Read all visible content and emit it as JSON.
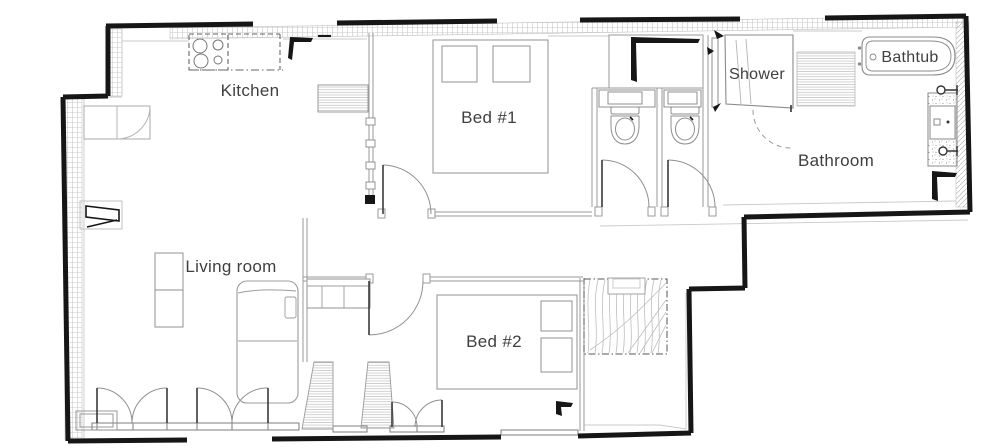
{
  "title": "Apartment floor plan",
  "colors": {
    "wall": "#161616",
    "line": "#8f8f8f",
    "light_line": "#c6c6c6",
    "hatch": "#bdbdbd",
    "text": "#3f3f3f",
    "background": "#ffffff"
  },
  "rooms": {
    "kitchen": {
      "label": "Kitchen"
    },
    "bed1": {
      "label": "Bed #1"
    },
    "shower": {
      "label": "Shower"
    },
    "bathtub": {
      "label": "Bathtub"
    },
    "bathroom": {
      "label": "Bathroom"
    },
    "living_room": {
      "label": "Living room"
    },
    "bed2": {
      "label": "Bed #2"
    }
  },
  "fixtures": [
    "stove",
    "kitchen-counter",
    "radiator",
    "entry-closet",
    "tv-unit",
    "bed-1",
    "bed-2",
    "pillows",
    "toilet-1",
    "toilet-2",
    "wc-sink-1",
    "wc-sink-2",
    "shower-stall",
    "shower-glass",
    "bathtub",
    "bath-mat",
    "vanity-sink",
    "sofa",
    "side-table",
    "wardrobe",
    "stairs",
    "french-doors",
    "window-sills"
  ]
}
